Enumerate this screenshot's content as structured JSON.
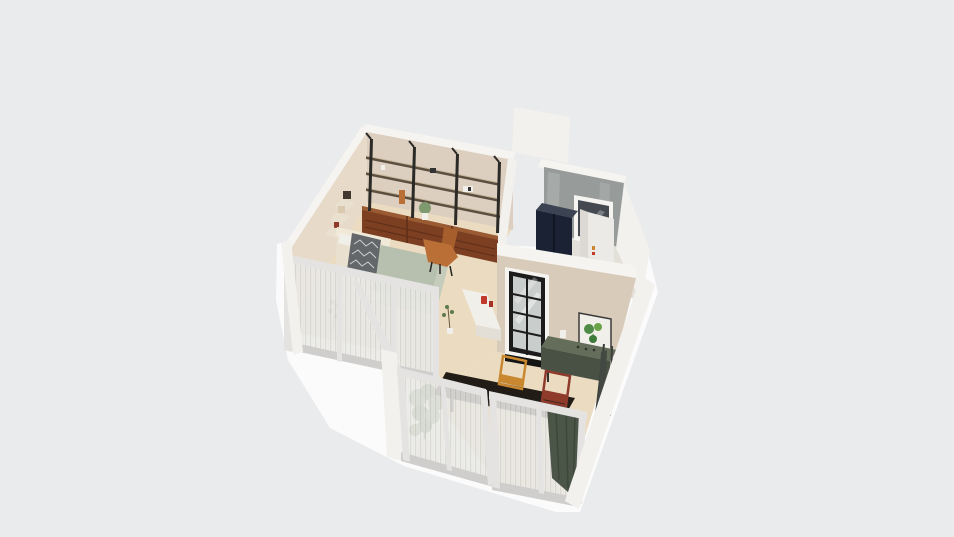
{
  "app": {
    "type": "3d-floorplan-isometric-render",
    "canvas_width": 954,
    "canvas_height": 537
  },
  "scene": {
    "rooms": [
      {
        "name": "study-living-room",
        "features": [
          "wall-shelving-units",
          "walnut-drawer-cabinets",
          "tan-lounge-chair",
          "wall-shelves-with-art",
          "kitchen-counter"
        ]
      },
      {
        "name": "bedroom",
        "features": [
          "bed-with-patterned-throw",
          "sage-rug",
          "glazed-partition-with-sheer-curtains"
        ]
      },
      {
        "name": "utility-room",
        "features": [
          "concrete-wall",
          "window",
          "navy-fridge",
          "white-cabinet"
        ]
      },
      {
        "name": "kitchen-dining-room",
        "features": [
          "steel-framed-glass-door",
          "botanical-artwork",
          "green-console",
          "easel",
          "dark-dining-table",
          "amber-chair",
          "maroon-chair"
        ]
      },
      {
        "name": "balcony-glazing",
        "features": [
          "sliding-glass-walls",
          "sheer-curtains",
          "green-curtain",
          "tall-potted-plant"
        ]
      }
    ]
  },
  "colors": {
    "background": "#eaebec",
    "ground": "#fbfbfb",
    "floor": "#ebdcc1",
    "floor_utility": "#e3e0da",
    "wall_beige": "#ddcfc0",
    "wall_beige_light": "#e7dac9",
    "wall_kitchen": "#d9cbba",
    "wall_cap": "#f6f4f1",
    "wall_white": "#f3f1ee",
    "concrete": "#979c9b",
    "window_glass": "#454a51",
    "shelf_wood": "#5a4f40",
    "shelf_highlight": "#c7b596",
    "metal_black": "#2b2a27",
    "drawer_walnut": "#7c3f22",
    "drawer_gap": "#5e2f18",
    "drawer_top": "#9a5b33",
    "bed_cream": "#e9e0cf",
    "bed_highlight": "#f1e9d8",
    "duvet_sage": "#b7bfae",
    "rug_sage": "#c6ccbc",
    "throw_dark": "#63676a",
    "chair_tan": "#b96f35",
    "chair_tan_dark": "#a65f2c",
    "chair_amber": "#c9872f",
    "chair_maroon": "#8e3b2c",
    "navy": "#1a2233",
    "navy_top": "#3c4453",
    "cabinet_white": "#eceae6",
    "cabinet_side": "#dcd9d4",
    "door_frame": "#1c1c1c",
    "door_glass": "#c9cdcb",
    "threshold": "#141414",
    "console_top": "#646c5a",
    "console_front": "#495144",
    "table_dark": "#221c16",
    "curtain_sheer": "#ececea",
    "curtain_sheer_stripe": "#d6d5d0",
    "curtain_green": "#4c5648",
    "frame_light": "#e4e3e2",
    "frame_mid": "#cfcecd",
    "plant_green": "#7f9a6e",
    "plant_dark": "#5d7a4d",
    "pot_white": "#f1efe9",
    "art_frame": "#3a3a3a",
    "art_green": "#4e8b46",
    "accent_red": "#c0392b"
  }
}
